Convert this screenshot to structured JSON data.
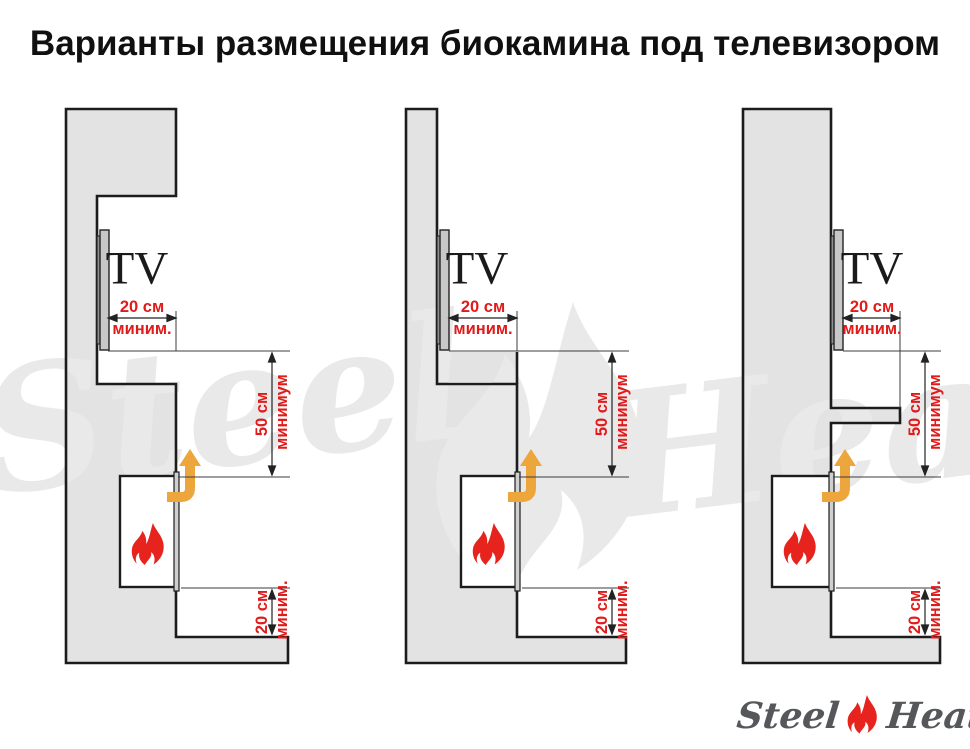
{
  "title": "Варианты размещения биокамина под телевизором",
  "tv_label": "TV",
  "dims": {
    "recess": {
      "value": "20 см",
      "qualifier": "миним."
    },
    "clearance": {
      "value": "50 см",
      "qualifier": "минимум"
    },
    "floor": {
      "value": "20 см",
      "qualifier": "миним."
    }
  },
  "watermark": {
    "left_word": "Steel",
    "right_word": "Heat"
  },
  "logo": {
    "left_word": "Steel",
    "right_word": "Heat"
  },
  "colors": {
    "dimension_red": "#e11a1a",
    "flame_red": "#e6231c",
    "arrow_orange": "#eca63c",
    "wall_fill": "#e3e3e3",
    "outline_black": "#1c1c1c",
    "watermark_gray": "#e9e9e9",
    "logo_gray": "#55575a"
  }
}
